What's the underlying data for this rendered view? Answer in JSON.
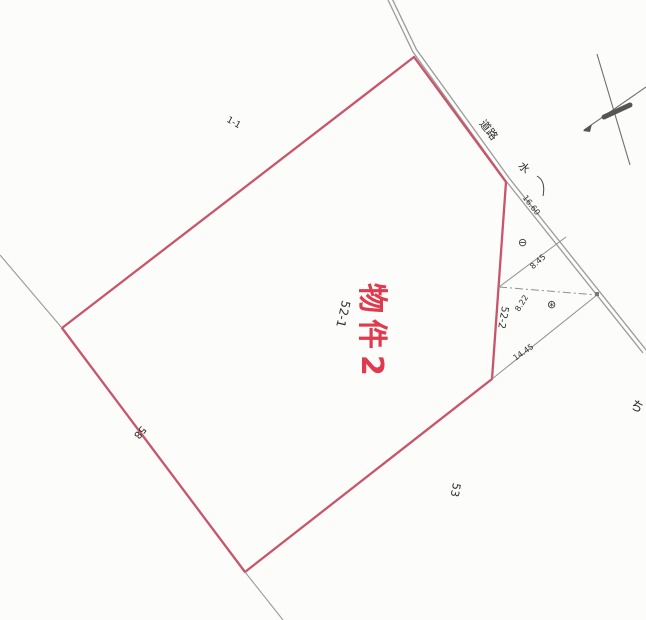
{
  "map": {
    "property_overlay": "物件2",
    "parcels": {
      "main_lot": "52-1",
      "sub_lot": "52-2"
    },
    "neighbors": {
      "top_left": "1-1",
      "bottom_right": "53",
      "bottom_left": "58",
      "right_edge_partial": "ち"
    },
    "road_strip": {
      "road_label": "道路",
      "water_label": "水",
      "frontage_length": "16.60"
    },
    "measurements": {
      "upper": "8.45",
      "middle": "8.22",
      "lower": "14.45"
    },
    "symbols": {
      "upper": "⊖",
      "lower": "⊛"
    },
    "colors": {
      "parcel_outline": "#c9556b",
      "property_text": "#e03a4e",
      "survey_line": "#8f8f8f",
      "ink": "#2e2e2e"
    }
  }
}
